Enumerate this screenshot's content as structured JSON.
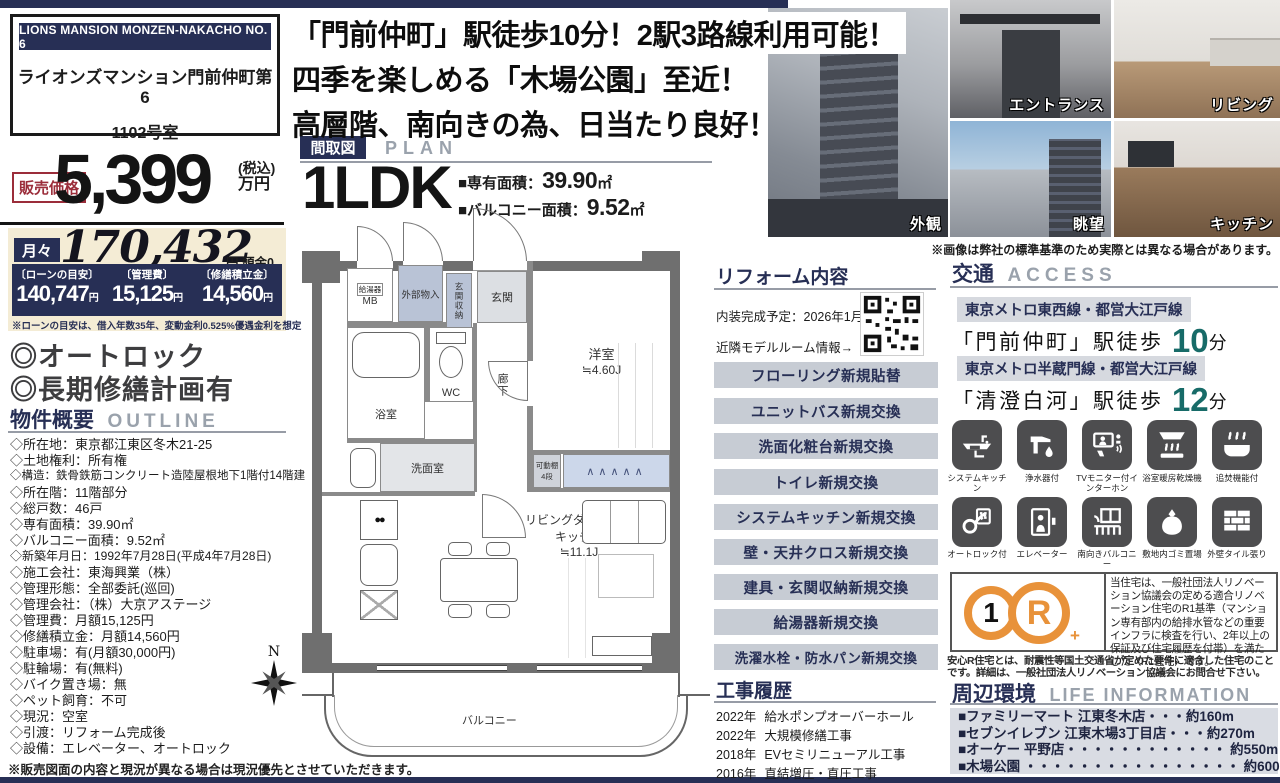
{
  "colors": {
    "navy": "#272f55",
    "accent_red": "#9b2d3a",
    "teal": "#176b68",
    "orange": "#e8923a",
    "beige": "#f4ecd5",
    "button_gray": "#c7ccd4"
  },
  "property": {
    "en_name": "LIONS MANSION MONZEN-NAKACHO NO. 6",
    "jp_name": "ライオンズマンション門前仲町第6",
    "room_no": "1102号室"
  },
  "price": {
    "label": "販売価格",
    "value": "5,399",
    "tax": "(税込)",
    "unit": "万円"
  },
  "monthly": {
    "label": "月々",
    "value": "170,432",
    "yen": "円",
    "down": "頭金0円",
    "note": "※ローンの目安は、借入年数35年、変動金利0.525%優遇金利を想定",
    "loan": [
      {
        "head": "〔ローンの目安〕",
        "value": "140,747",
        "unit": "円"
      },
      {
        "head": "〔管理費〕",
        "value": "15,125",
        "unit": "円"
      },
      {
        "head": "〔修繕積立金〕",
        "value": "14,560",
        "unit": "円"
      }
    ]
  },
  "features": [
    "◎オートロック",
    "◎長期修繕計画有"
  ],
  "outline": {
    "title_jp": "物件概要",
    "title_en": "OUTLINE",
    "items": [
      "◇所在地：東京都江東区冬木21-25",
      "◇土地権利：所有権",
      "◇構造：鉄骨鉄筋コンクリート造陸屋根地下1階付14階建",
      "◇所在階：11階部分",
      "◇総戸数：46戸",
      "◇専有面積：39.90㎡",
      "◇バルコニー面積：9.52㎡",
      "◇新築年月日：1992年7月28日(平成4年7月28日)",
      "◇施工会社：東海興業（株）",
      "◇管理形態：全部委託(巡回)",
      "◇管理会社：（株）大京アステージ",
      "◇管理費：月額15,125円",
      "◇修繕積立金：月額14,560円",
      "◇駐車場：有(月額30,000円)",
      "◇駐輪場：有(無料)",
      "◇バイク置き場：無",
      "◇ペット飼育：不可",
      "◇現況：空室",
      "◇引渡：リフォーム完成後",
      "◇設備：エレベーター、オートロック"
    ]
  },
  "left_disclaimer": "※販売図面の内容と現況が異なる場合は現況優先とさせていただきます。",
  "headline": {
    "line1": "「門前仲町」駅徒歩10分！2駅3路線利用可能！",
    "line2": "四季を楽しめる「木場公園」至近！",
    "line3": "高層階、南向きの為、日当たり良好！"
  },
  "plan": {
    "title_jp": "間取図",
    "title_en": "PLAN",
    "type": "1LDK",
    "area1_label": "■専有面積：",
    "area1_value": "39.90",
    "area1_unit": "㎡",
    "area2_label": "■バルコニー面積：",
    "area2_value": "9.52",
    "area2_unit": "㎡",
    "rooms": {
      "mb": "MB",
      "water_heater": "給湯器",
      "storage_ext": "外部物入",
      "entrance_storage": "玄関収納",
      "entrance": "玄関",
      "bedroom": "洋室",
      "bedroom_size": "≒4.60J",
      "bath": "浴室",
      "wc": "WC",
      "washroom": "洗面室",
      "corridor": "廊下",
      "shelf": "可動棚",
      "shelf_tiers": "4段",
      "ldk_line1": "リビングダイニング",
      "ldk_line2": "キッチン",
      "ldk_size": "≒11.1J",
      "balcony": "バルコニー",
      "compass": "N"
    }
  },
  "photos": [
    {
      "label": "外観"
    },
    {
      "label": "エントランス"
    },
    {
      "label": "リビング"
    },
    {
      "label": "眺望"
    },
    {
      "label": "キッチン"
    }
  ],
  "photo_note": "※画像は弊社の標準基準のため実際とは異なる場合があります。",
  "reform": {
    "title": "リフォーム内容",
    "completion": "内装完成予定：2026年1月頃",
    "model_room": "近隣モデルルーム情報→",
    "items": [
      "フローリング新規貼替",
      "ユニットバス新規交換",
      "洗面化粧台新規交換",
      "トイレ新規交換",
      "システムキッチン新規交換",
      "壁・天井クロス新規交換",
      "建具・玄関収納新規交換",
      "給湯器新規交換",
      "洗濯水栓・防水パン新規交換"
    ]
  },
  "construction": {
    "title": "工事履歴",
    "rows": [
      {
        "year": "2022年",
        "desc": "給水ポンプオーバーホール"
      },
      {
        "year": "2022年",
        "desc": "大規模修繕工事"
      },
      {
        "year": "2018年",
        "desc": "EVセミリニューアル工事"
      },
      {
        "year": "2016年",
        "desc": "直結増圧・直圧工事"
      }
    ]
  },
  "access": {
    "title_jp": "交通",
    "title_en": "ACCESS",
    "routes": [
      {
        "line": "東京メトロ東西線・都営大江戸線",
        "station": "「門前仲町」",
        "walk": "駅徒歩",
        "minutes": "10",
        "unit": "分"
      },
      {
        "line": "東京メトロ半蔵門線・都営大江戸線",
        "station": "「清澄白河」",
        "walk": "駅徒歩",
        "minutes": "12",
        "unit": "分"
      }
    ]
  },
  "equipment": {
    "items": [
      {
        "icon": "system-kitchen-icon",
        "label": "システムキッチン"
      },
      {
        "icon": "water-purifier-icon",
        "label": "浄水器付"
      },
      {
        "icon": "tv-intercom-icon",
        "label": "TVモニター付インターホン"
      },
      {
        "icon": "bathroom-dryer-icon",
        "label": "浴室暖房乾燥機"
      },
      {
        "icon": "reheating-bath-icon",
        "label": "追焚機能付"
      },
      {
        "icon": "auto-lock-icon",
        "label": "オートロック付"
      },
      {
        "icon": "elevator-icon",
        "label": "エレベーター"
      },
      {
        "icon": "south-balcony-icon",
        "label": "南向きバルコニー"
      },
      {
        "icon": "garbage-area-icon",
        "label": "敷地内ゴミ置場"
      },
      {
        "icon": "tile-wall-icon",
        "label": "外壁タイル張り"
      }
    ]
  },
  "r1": {
    "badge_number": "1",
    "badge_letter": "R",
    "text": "当住宅は、一般社団法人リノベーション協議会の定める適合リノベーション住宅のR1基準（マンション専有部内の給排水管などの重要インフラに検査を行い、2年以上の保証及び住宅履歴を付帯）を満たした〈R1住宅〉です。",
    "note": "安心R住宅とは、耐震性等国土交通省が定めた要件に適合した住宅のことです。詳細は、一般社団法人リノベーション協議会にお問合せ下さい。"
  },
  "life": {
    "title_jp": "周辺環境",
    "title_en": "LIFE INFORMATION",
    "items": [
      "■ファミリーマート 江東冬木店・・・約160m",
      "■セブンイレブン 江東木場3丁目店・・・約270m",
      "■オーケー 平野店・・・・・・・・・・・・ 約550m",
      "■木場公園 ・・・・・・・・・・・・・・・・ 約600m"
    ]
  }
}
